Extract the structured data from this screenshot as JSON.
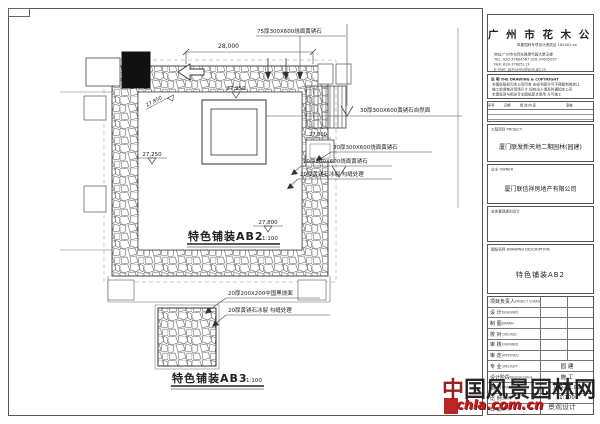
{
  "company": {
    "name": "广 州 市 花 木 公 司",
    "qualification": "风景园林专项设计资质证 182401-sa",
    "address": "地址:广州市先烈东路翠竹园大厦五楼",
    "tel": "TEL: 020-37604567  020-37605057",
    "fax": "FAX: 020-37605113",
    "email": "E-mail: gzhuamu@pub.gd.cn"
  },
  "notes": {
    "title": "说 明  THE DRAWING & COPYRIGHT",
    "items": [
      "本图纸版权归本公司所有 未经书面许可不得复制或转让",
      "施工前请核对现场尺寸 如有出入请及时通知本公司",
      "本图纸须与相关专业图纸配合使用 方可施工"
    ]
  },
  "revision": {
    "headers": [
      "序号",
      "日期",
      "修 改 内 容",
      "审核"
    ]
  },
  "project": {
    "label": "工程项目  PROJECT",
    "name": "厦门联发新天地二期园林(园建)"
  },
  "owner": {
    "label": "业主  OWNER",
    "name": "厦门联信祥房地产有限公司"
  },
  "planning": {
    "label": "总体景观规划设计"
  },
  "drawing": {
    "label": "图纸名称  DRAWING DESCRIPTION",
    "name": "特色铺装AB2"
  },
  "signature_rows": [
    {
      "label": "项目负责人",
      "en": "PROJECT CHARGE",
      "value": ""
    },
    {
      "label": "设 计",
      "en": "DESIGNED",
      "value": ""
    },
    {
      "label": "制 图",
      "en": "DRAWN",
      "value": ""
    },
    {
      "label": "校 对",
      "en": "CHECKED",
      "value": ""
    },
    {
      "label": "审 核",
      "en": "EXAMINED",
      "value": ""
    },
    {
      "label": "审 定",
      "en": "APPROVED",
      "value": ""
    },
    {
      "label": "专 业",
      "en": "SPECIALTY",
      "value": "园 建"
    },
    {
      "label": "设计阶段",
      "en": "DESIGN STAGE",
      "value": "施 工"
    },
    {
      "label": "图 号",
      "en": "DRAWING No.",
      "value": "JAD-12.01"
    },
    {
      "label": "比 例",
      "en": "SCALE",
      "value": "1:100"
    },
    {
      "label": "日 期",
      "en": "DATE",
      "value": ""
    }
  ],
  "plan": {
    "title_ab2": "特色铺装AB2",
    "title_ab3": "特色铺装AB3",
    "scale": "1:100",
    "dimension_top": "28,000",
    "levels": {
      "center": "27,950",
      "ring": "27,850",
      "bottom": "27,800",
      "left": "27,250",
      "right": "27,800"
    },
    "annotations": {
      "a75": "75厚300X600烧面黄锈石",
      "a30_natural": "30厚300X600黄锈石自然面",
      "a30_burn": "30厚300X600烧面黄锈石",
      "a20_burn": "20厚300X600烧面黄锈石",
      "a20_ice": "20厚黄锈石冰裂  勾缝处理",
      "b20_black": "20厚200X200中国黑烧面",
      "b20_ice": "20厚黄锈石冰裂  勾缝处理"
    }
  },
  "watermark": {
    "first": "中",
    "rest": "国风景园林网",
    "url": "chla.com.cn",
    "tail": "景观设计"
  }
}
